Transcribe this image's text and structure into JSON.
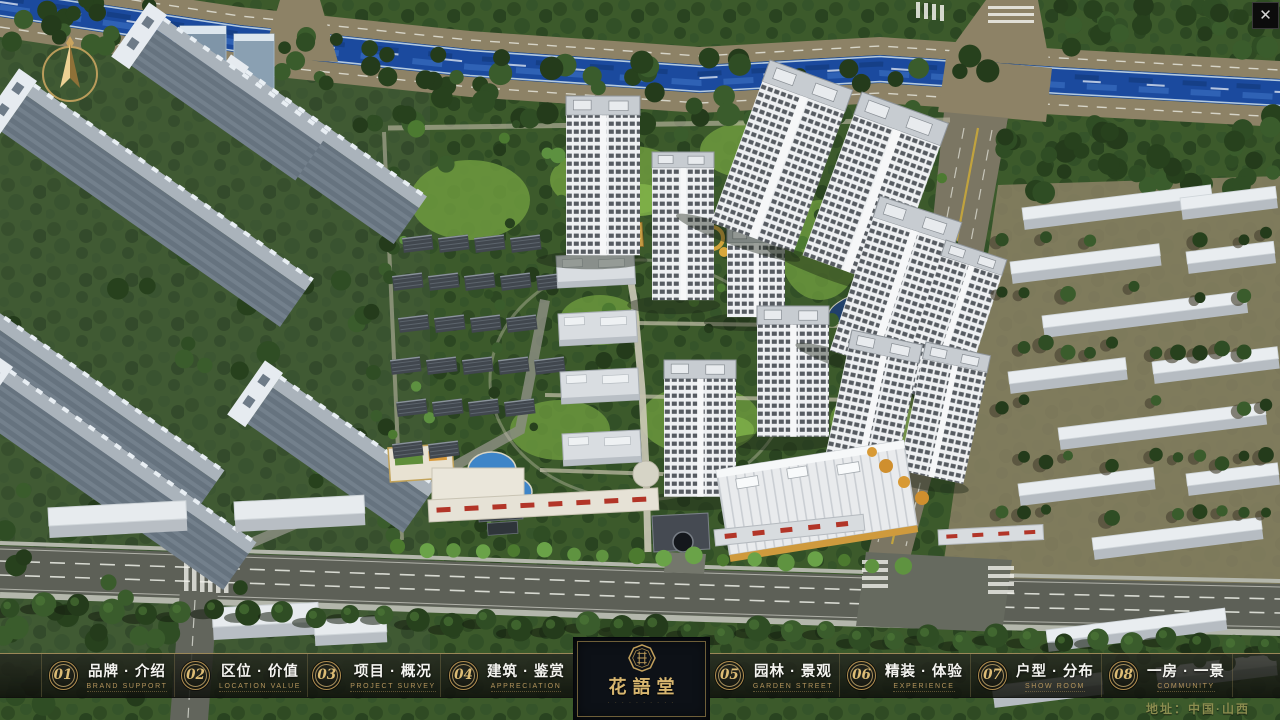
{
  "navbar": {
    "items": [
      {
        "num": "01",
        "zh": "品牌 · 介绍",
        "en": "BRAND SUPPORT"
      },
      {
        "num": "02",
        "zh": "区位 · 价值",
        "en": "LOCATION VALUE"
      },
      {
        "num": "03",
        "zh": "项目 · 概况",
        "en": "PROJECT SURVEY"
      },
      {
        "num": "04",
        "zh": "建筑 · 鉴赏",
        "en": "APPRECIATION"
      },
      {
        "num": "05",
        "zh": "园林 · 景观",
        "en": "GARDEN STREET"
      },
      {
        "num": "06",
        "zh": "精装 · 体验",
        "en": "EXPERIENCE"
      },
      {
        "num": "07",
        "zh": "户型 · 分布",
        "en": "SHOW ROOM"
      },
      {
        "num": "08",
        "zh": "一房 · 一景",
        "en": "COMMUNITY"
      }
    ]
  },
  "logo": {
    "title": "花語堂",
    "caption": "· · · · · · · · · ·"
  },
  "footer": {
    "address": "地址：中国·山西"
  },
  "window": {
    "close_glyph": "✕"
  },
  "icons": {
    "compass": "north-arrow",
    "close": "x-mark"
  },
  "colors": {
    "gold": "#c9a25e",
    "bar_bg": "#14160f",
    "river": "#1b4a9e",
    "tree_green": "#2f4d24",
    "road_gray": "#5d6057",
    "sign_red": "#b23528"
  }
}
